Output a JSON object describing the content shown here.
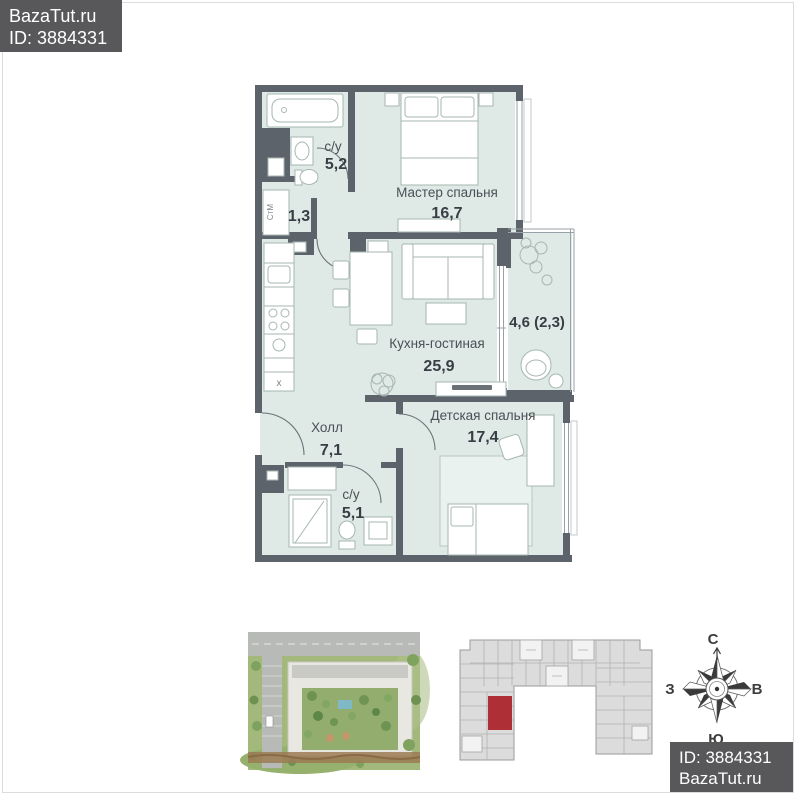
{
  "watermark_top": {
    "site": "BazaTut.ru",
    "listing_id": "ID: 3884331"
  },
  "watermark_bottom": {
    "listing_id": "ID: 3884331",
    "site": "BazaTut.ru"
  },
  "floorplan": {
    "rooms": [
      {
        "name": "с/у",
        "area": "5,2"
      },
      {
        "name": "",
        "area": "1,3"
      },
      {
        "name": "Мастер спальня",
        "area": "16,7"
      },
      {
        "name": "Кухня-гостиная",
        "area": "25,9"
      },
      {
        "name": "",
        "area": "4,6 (2,3)"
      },
      {
        "name": "Детская спальня",
        "area": "17,4"
      },
      {
        "name": "Холл",
        "area": "7,1"
      },
      {
        "name": "с/у",
        "area": "5,1"
      }
    ],
    "appliances": {
      "washing_machine": "СтМ",
      "dishwasher_mark": "х"
    },
    "colors": {
      "wall": "#5c636a",
      "floor": "#dfe9e6",
      "label": "#4a5055"
    }
  },
  "building_plan": {
    "highlight_color": "#ae2f36"
  },
  "compass": {
    "north": "С",
    "south": "Ю",
    "east": "В",
    "west": "З"
  }
}
